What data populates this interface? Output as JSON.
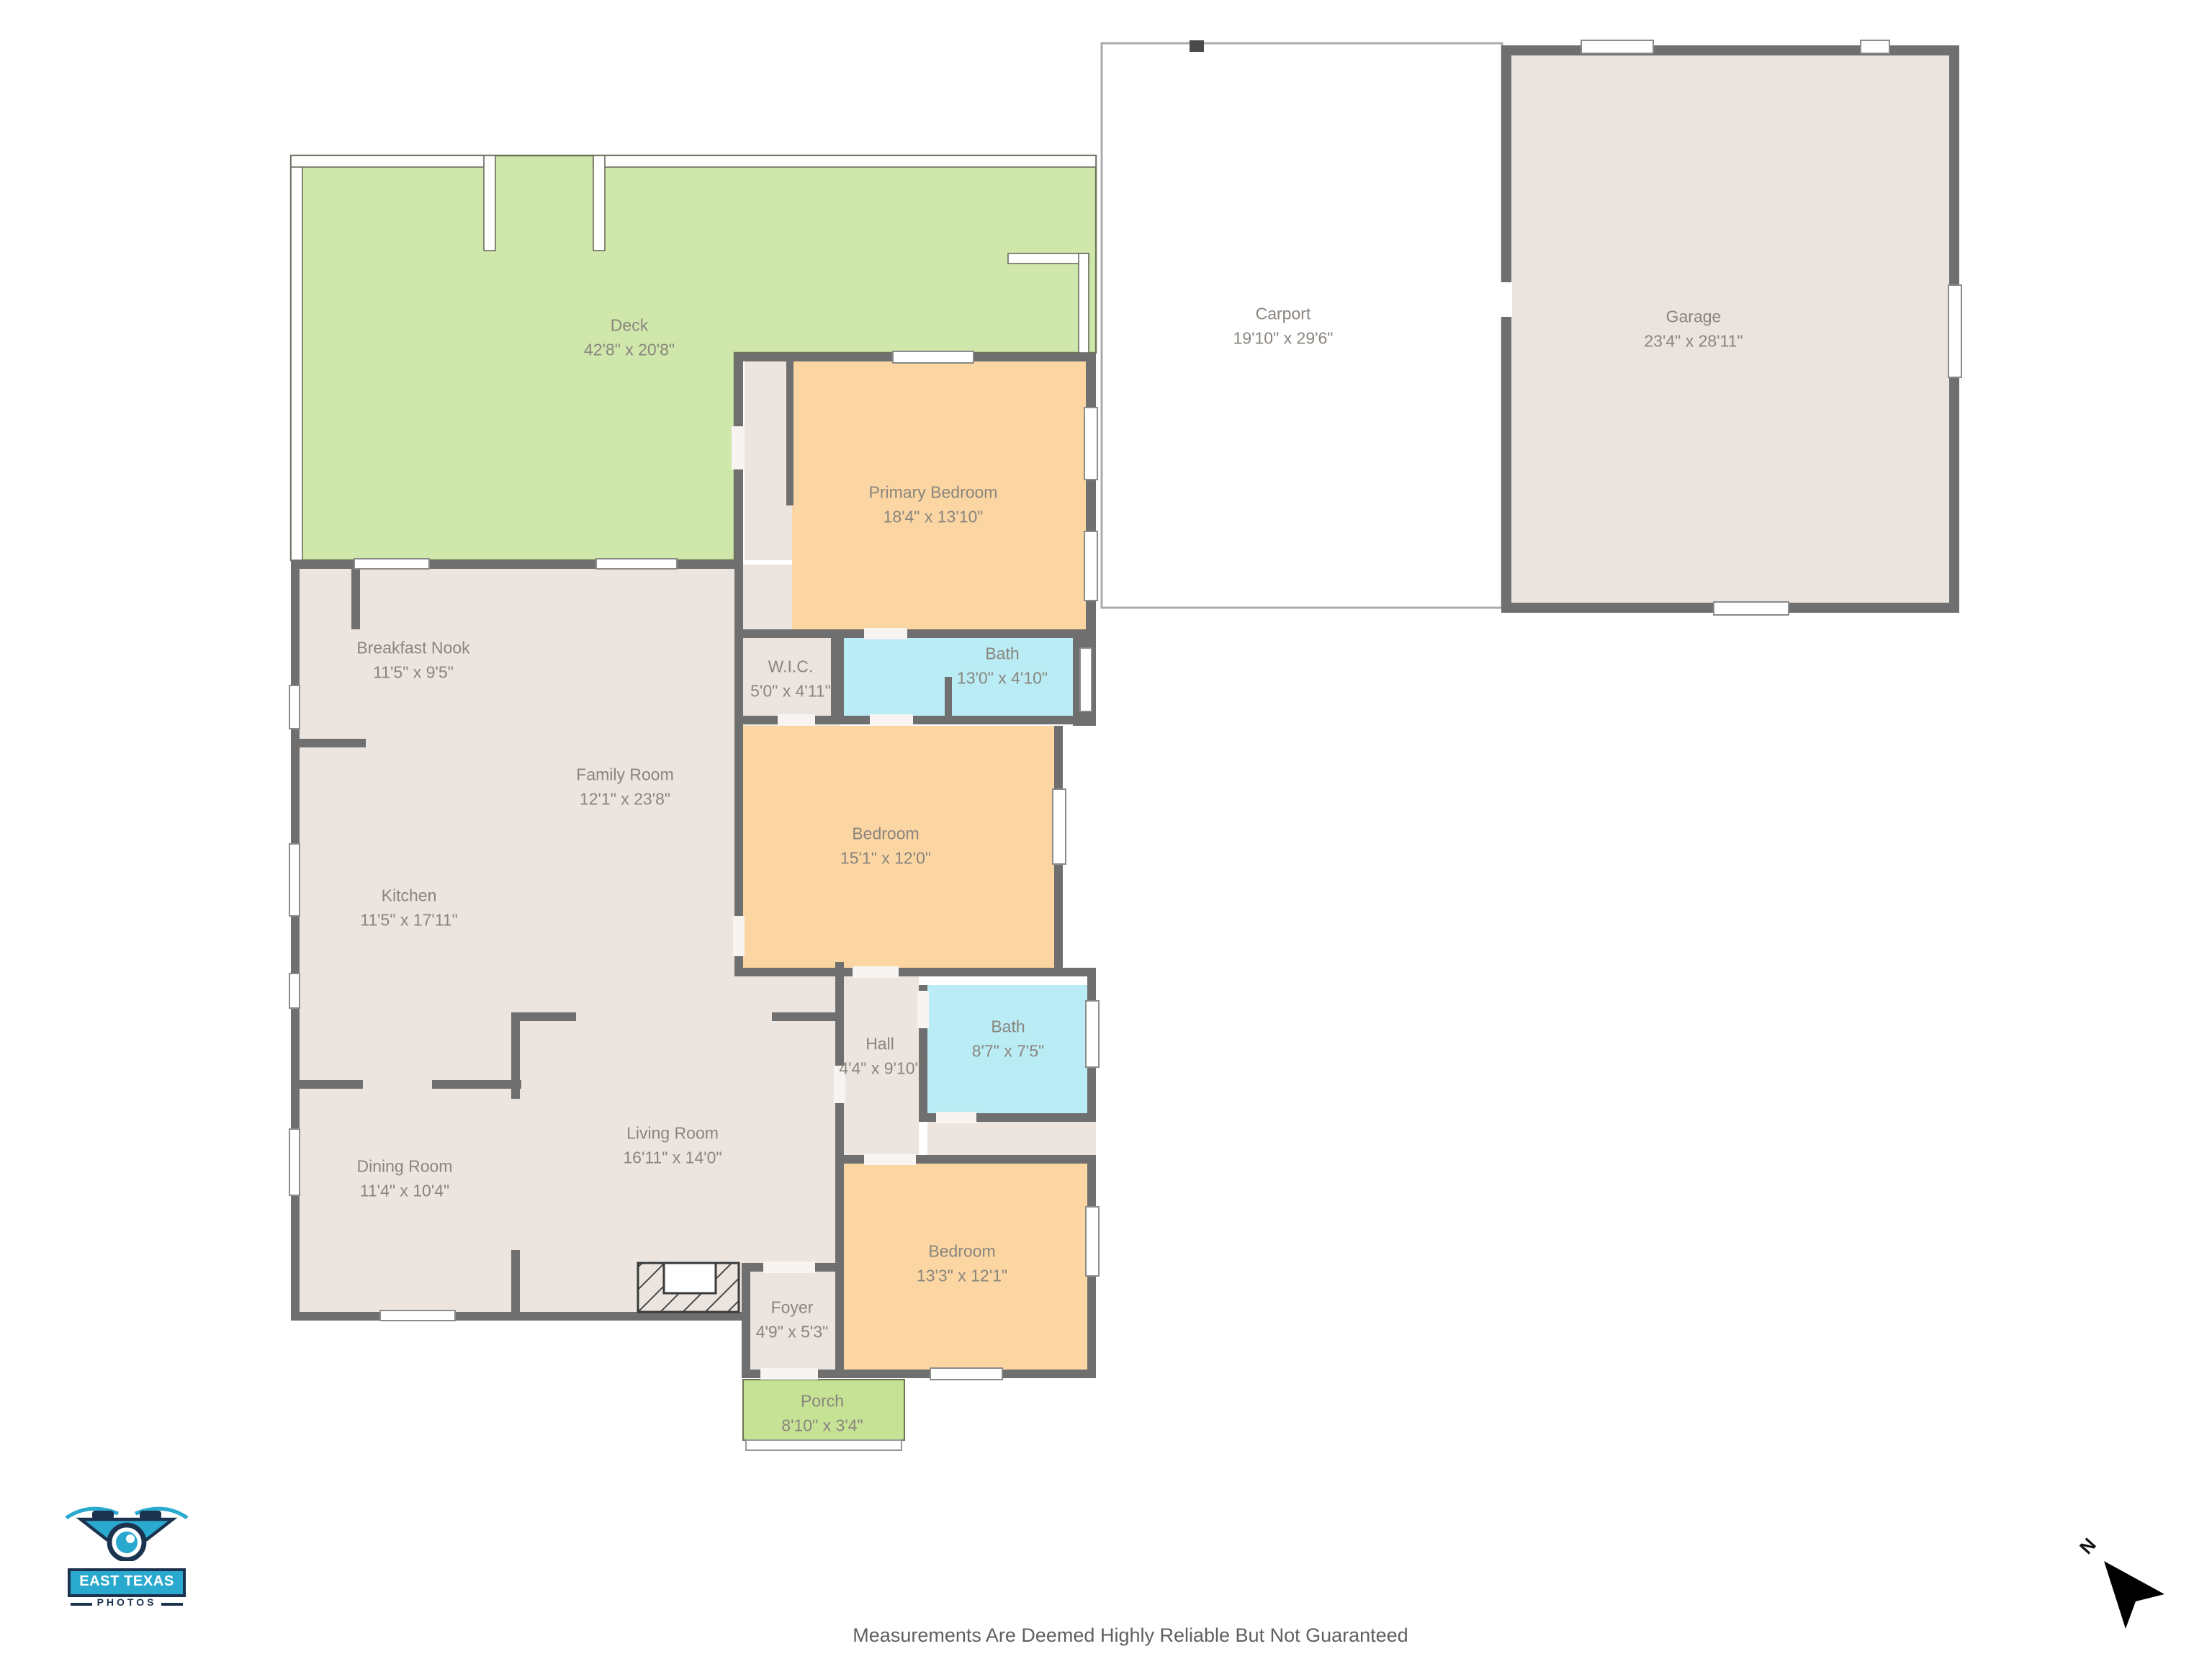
{
  "rooms": {
    "deck": {
      "name": "Deck",
      "dims": "42'8\" x 20'8\""
    },
    "carport": {
      "name": "Carport",
      "dims": "19'10\" x 29'6\""
    },
    "garage": {
      "name": "Garage",
      "dims": "23'4\" x 28'11\""
    },
    "primary_bedroom": {
      "name": "Primary Bedroom",
      "dims": "18'4\" x 13'10\""
    },
    "wic": {
      "name": "W.I.C.",
      "dims": "5'0\" x 4'11\""
    },
    "bath_top": {
      "name": "Bath",
      "dims": "13'0\" x 4'10\""
    },
    "breakfast_nook": {
      "name": "Breakfast Nook",
      "dims": "11'5\" x 9'5\""
    },
    "family_room": {
      "name": "Family Room",
      "dims": "12'1\" x 23'8\""
    },
    "kitchen": {
      "name": "Kitchen",
      "dims": "11'5\" x 17'11\""
    },
    "bedroom_mid": {
      "name": "Bedroom",
      "dims": "15'1\" x 12'0\""
    },
    "hall": {
      "name": "Hall",
      "dims": "4'4\" x 9'10\""
    },
    "bath_mid": {
      "name": "Bath",
      "dims": "8'7\" x 7'5\""
    },
    "dining_room": {
      "name": "Dining Room",
      "dims": "11'4\" x 10'4\""
    },
    "living_room": {
      "name": "Living Room",
      "dims": "16'11\" x 14'0\""
    },
    "bedroom_bottom": {
      "name": "Bedroom",
      "dims": "13'3\" x 12'1\""
    },
    "foyer": {
      "name": "Foyer",
      "dims": "4'9\" x 5'3\""
    },
    "porch": {
      "name": "Porch",
      "dims": "8'10\" x 3'4\""
    }
  },
  "footer": {
    "disclaimer": "Measurements Are Deemed Highly Reliable But Not Guaranteed"
  },
  "logo": {
    "name": "EAST TEXAS",
    "sub": "PHOTOS"
  },
  "compass": {
    "north_label": "N"
  },
  "colors": {
    "wall": "#6f6f6f",
    "interior": "#ece5df",
    "bedroom": "#fbd6a2",
    "bath": "#b9ecf4",
    "deck": "#cfe7ab",
    "porch": "#c5e295",
    "garage": "#ebe3dd",
    "carport": "#ffffff",
    "label_text": "#8a857f",
    "logo_cyan": "#2aa9cf",
    "logo_navy": "#1c3350"
  }
}
